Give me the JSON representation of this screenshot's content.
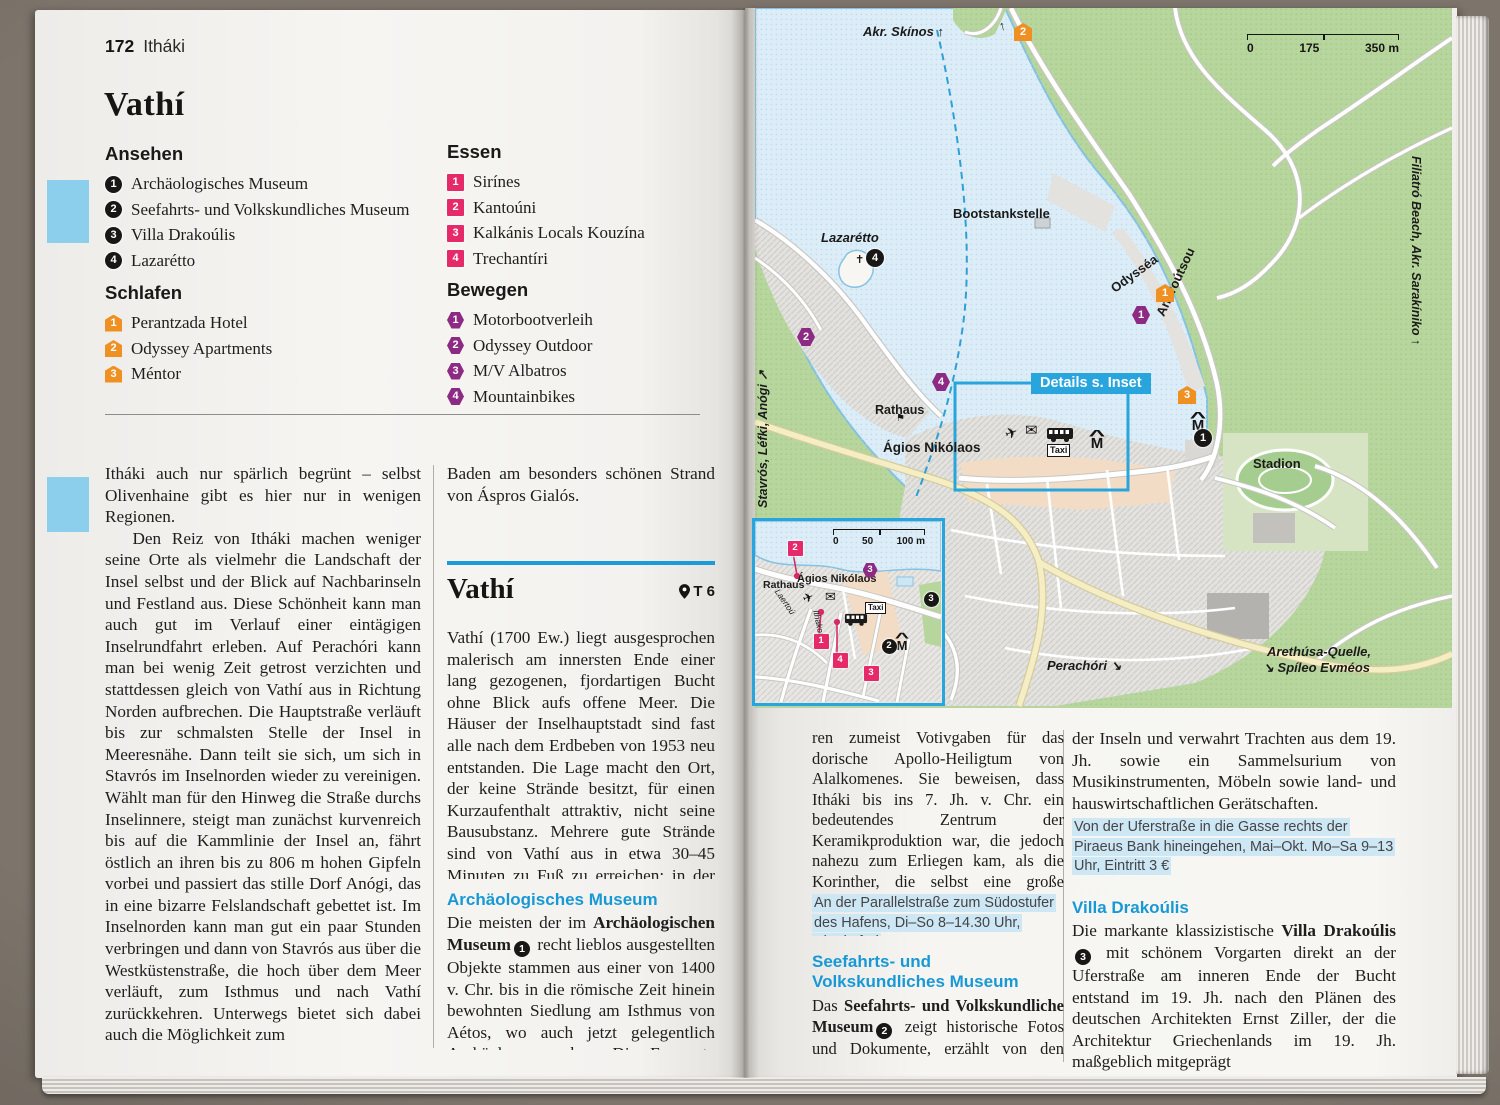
{
  "left_page": {
    "page_num": "172",
    "header": "Itháki",
    "title": "Vathí",
    "lists": {
      "ansehen": {
        "title": "Ansehen",
        "kind": "sight",
        "items": [
          "Archäologisches Museum",
          "Seefahrts- und Volkskundliches Museum",
          "Villa Drakoúlis",
          "Lazarétto"
        ]
      },
      "essen": {
        "title": "Essen",
        "kind": "food",
        "items": [
          "Sirínes",
          "Kantoúni",
          "Kalkánis Locals Kouzína",
          "Trechantíri"
        ]
      },
      "schlafen": {
        "title": "Schlafen",
        "kind": "hotel",
        "items": [
          "Perantzada Hotel",
          "Odyssey Apartments",
          "Méntor"
        ]
      },
      "bewegen": {
        "title": "Bewegen",
        "kind": "move",
        "items": [
          "Motorbootverleih",
          "Odyssey Outdoor",
          "M/V Albatros",
          "Mountainbikes"
        ]
      }
    },
    "col1_p1": "Itháki auch nur spärlich begrünt – selbst Olivenhaine gibt es hier nur in wenigen Regionen.",
    "col1_p2": "Den Reiz von Itháki machen weniger seine Orte als vielmehr die Landschaft der Insel selbst und der Blick auf Nachbarinseln und Festland aus. Diese Schönheit kann man auch gut im Verlauf einer eintägigen Inselrundfahrt erleben. Auf Perachóri kann man bei wenig Zeit getrost verzichten und stattdessen gleich von Vathí aus in Richtung Norden aufbrechen. Die Hauptstraße verläuft bis zur schmalsten Stelle der Insel in Meeresnähe. Dann teilt sie sich, um sich in Stavrós im Inselnorden wieder zu vereinigen. Wählt man für den Hinweg die Straße durchs Inselinnere, steigt man zunächst kurvenreich bis auf die Kammlinie der Insel an, fährt östlich an ihren bis zu 806 m hohen Gipfeln vorbei und passiert das stille Dorf Anógi, das in eine bizarre Felslandschaft gebettet ist. Im Inselnorden kann man gut ein paar Stunden verbringen und dann von Stavrós aus über die Westküstenstraße, die hoch über dem Meer verläuft, zum Isthmus und nach Vathí zurückkehren. Unterwegs bietet sich dabei auch die Möglichkeit zum",
    "col2_intro": "Baden am besonders schönen Strand von Áspros Gialós.",
    "section_title": "Vathí",
    "section_ref": "T 6",
    "section_para": "Vathí (1700 Ew.) liegt ausgesprochen malerisch am innersten Ende einer lang gezogenen, fjordartigen Bucht ohne Blick aufs offene Meer. Die Häuser der Inselhauptstadt sind fast alle nach dem Erdbeben von 1953 neu entstanden. Die Lage macht den Ort, der keine Strände besitzt, für einen Kurzaufenthalt attraktiv, nicht seine Bausubstanz. Mehrere gute Strände sind von Vathí aus in etwa 30–45 Minuten zu Fuß zu erreichen; in der Hochsaison fahren auch Boote dorthin.",
    "sub1_title": "Archäologisches Museum",
    "sub1": {
      "a": "Die meisten der im ",
      "b": "Archäologischen Museum",
      "badge": "1",
      "c": " recht lieblos ausgestellten Objekte stammen aus einer von 1400 v. Chr. bis in die römische Zeit hinein bewohnten Siedlung am Isthmus von Aétos, wo auch jetzt gelegentlich Archäologen graben. Die Exponate wa-"
    }
  },
  "right_page": {
    "col1_p1": "ren zumeist Votivgaben für das dorische Apollo-Heiligtum von Alalkomenes. Sie beweisen, dass Itháki bis ins 7. Jh. v. Chr. ein bedeutendes Zentrum der Keramikproduktion war, die jedoch nahezu zum Erliegen kam, als die Korinther, die selbst eine große Keramikindustrie besaßen, die Ionischen Inseln kolonisierten.",
    "info1": "An der Parallelstraße zum Südostufer des Hafens, Di–So 8–14.30 Uhr, Eintritt frei",
    "head2": "Seefahrts- und Volkskundliches Museum",
    "p2": {
      "a": "Das ",
      "b": "Seefahrts- und Volkskundliche Museum",
      "badge": "2",
      "c": " zeigt historische Fotos und Dokumente, erzählt von den Reedern"
    },
    "col2_p1": "der Inseln und verwahrt Trachten aus dem 19. Jh. sowie ein Sammelsurium von Musikinstrumenten, Möbeln sowie land- und hauswirtschaftlichen Gerätschaften.",
    "info2": "Von der Uferstraße in die Gasse rechts der Piraeus Bank hineingehen, Mai–Okt. Mo–Sa 9–13 Uhr, Eintritt 3 €",
    "head3": "Villa Drakoúlis",
    "p3": {
      "a": "Die markante klassizistische ",
      "b": "Villa Drakoúlis",
      "badge": "3",
      "c": " mit schönem Vorgarten direkt an der Uferstraße am inneren Ende der Bucht entstand im 19. Jh. nach den Plänen des deutschen Architekten Ernst Ziller, der die Architektur Griechenlands im 19. Jh. maßgeblich mitgeprägt"
    }
  },
  "map": {
    "labels": {
      "akr_skinos": "Akr. Skínos",
      "bootstankstelle": "Bootstankstelle",
      "lazaretto": "Lazarétto",
      "odyssea": "Odysséa",
      "androutsou": "Androútsou",
      "rathaus": "Rathaus",
      "agios_nikolaos": "Ágios Nikólaos",
      "stadion": "Stadion",
      "details_inset": "Details s. Inset",
      "stavros": "Stavrós, Léfki, Anógi",
      "perachori": "Perachóri",
      "arethousa_1": "Arethúsa-Quelle,",
      "arethousa_2": "Spíleo Evméos",
      "filiatro": "Filiatró Beach, Akr. Sarakíniko",
      "taxi": "Taxi",
      "inset_rathaus": "Rathaus",
      "inset_agios": "Ágios Nikólaos",
      "inset_street1": "Laertoú",
      "inset_street2": "Ithakoú"
    },
    "icons": {
      "plane": "✈",
      "mail": "✉",
      "church": "✝",
      "flag": "⚑",
      "arrow_up": "↑",
      "arrow_ne": "↗",
      "arrow_se": "↘",
      "museum": "M"
    },
    "scale_main": {
      "t0": "0",
      "t1": "175",
      "t2": "350 m"
    },
    "scale_inset": {
      "t0": "0",
      "t1": "50",
      "t2": "100 m"
    },
    "markers_main": [
      {
        "k": "hotel",
        "n": "2",
        "x": 268,
        "y": 24
      },
      {
        "k": "move",
        "n": "2",
        "x": 51,
        "y": 329
      },
      {
        "k": "move",
        "n": "4",
        "x": 186,
        "y": 374
      },
      {
        "k": "move",
        "n": "1",
        "x": 386,
        "y": 307
      },
      {
        "k": "hotel",
        "n": "1",
        "x": 410,
        "y": 285
      },
      {
        "k": "hotel",
        "n": "3",
        "x": 432,
        "y": 387
      },
      {
        "k": "sight",
        "n": "4",
        "x": 120,
        "y": 250
      },
      {
        "k": "sight",
        "n": "1",
        "x": 448,
        "y": 430
      }
    ],
    "markers_inset": [
      {
        "k": "food",
        "n": "2",
        "x": 40,
        "y": 27
      },
      {
        "k": "move",
        "n": "3",
        "x": 115,
        "y": 49
      },
      {
        "k": "sight",
        "n": "3",
        "x": 176,
        "y": 78
      },
      {
        "k": "food",
        "n": "1",
        "x": 66,
        "y": 120
      },
      {
        "k": "food",
        "n": "4",
        "x": 85,
        "y": 139
      },
      {
        "k": "food",
        "n": "3",
        "x": 116,
        "y": 152
      },
      {
        "k": "sight",
        "n": "2",
        "x": 134,
        "y": 125
      }
    ],
    "colors": {
      "accent_blue": "#29a5de",
      "sight": "#181715",
      "food": "#e62a69",
      "hotel": "#ef9122",
      "move": "#8d2a83"
    }
  }
}
